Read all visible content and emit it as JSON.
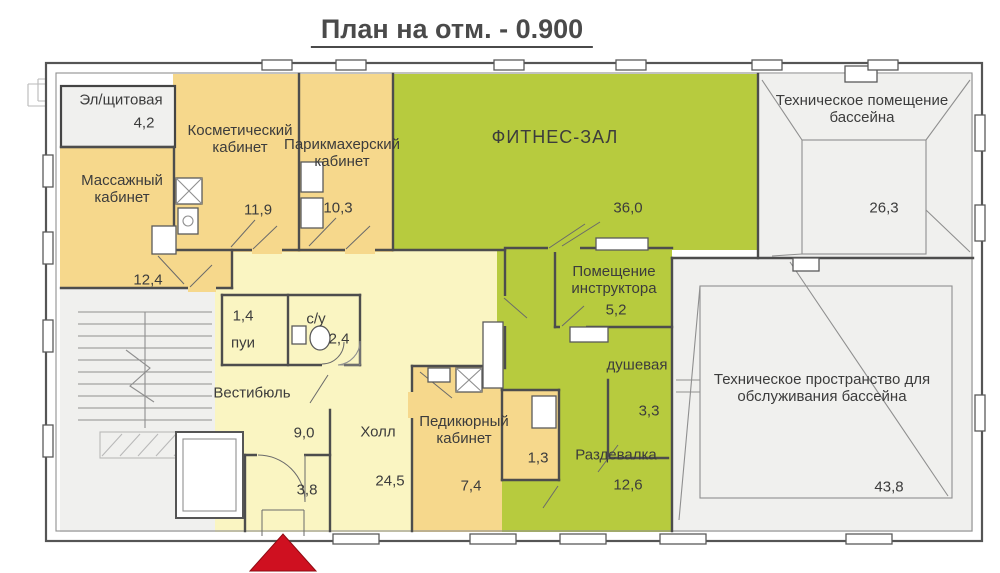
{
  "title": "План на отм. - 0.900",
  "palette": {
    "room-orange": "#f6d88c",
    "room-yellow": "#faf5c2",
    "room-green": "#b7cb3e",
    "room-gray": "#f0f0ee",
    "wall": "#4d4d4d",
    "entrance-red": "#cf1020"
  },
  "rooms": {
    "electrical": {
      "name": "Эл/щитовая",
      "area": "4,2"
    },
    "massage": {
      "name": "Массажный кабинет",
      "area": "12,4"
    },
    "cosmetic": {
      "name": "Косметический кабинет",
      "area": "11,9"
    },
    "hairdresser": {
      "name": "Парикмахерский кабинет",
      "area": "10,3"
    },
    "fitness": {
      "name": "ФИТНЕС-ЗАЛ",
      "area": "36,0"
    },
    "pool_tech_room": {
      "name": "Техническое помещение бассейна",
      "area": "26,3"
    },
    "instructor": {
      "name": "Помещение инструктора",
      "area": "5,2"
    },
    "shower": {
      "name": "душевая",
      "area": "3,3"
    },
    "cleaning": {
      "name": "пуи",
      "area": "1,4"
    },
    "wc": {
      "name": "с/у",
      "area": "2,4"
    },
    "vestibule": {
      "name": "Вестибюль",
      "area": "9,0"
    },
    "tambour": {
      "area": "3,8"
    },
    "hall": {
      "name": "Холл",
      "area": "24,5"
    },
    "pedicure": {
      "name": "Педикюрный кабинет",
      "area": "7,4"
    },
    "small_room": {
      "area": "1,3"
    },
    "changing": {
      "name": "Раздевалка",
      "area": "12,6"
    },
    "pool_tech_space": {
      "name": "Техническое пространство для обслуживания бассейна",
      "area": "43,8"
    }
  }
}
